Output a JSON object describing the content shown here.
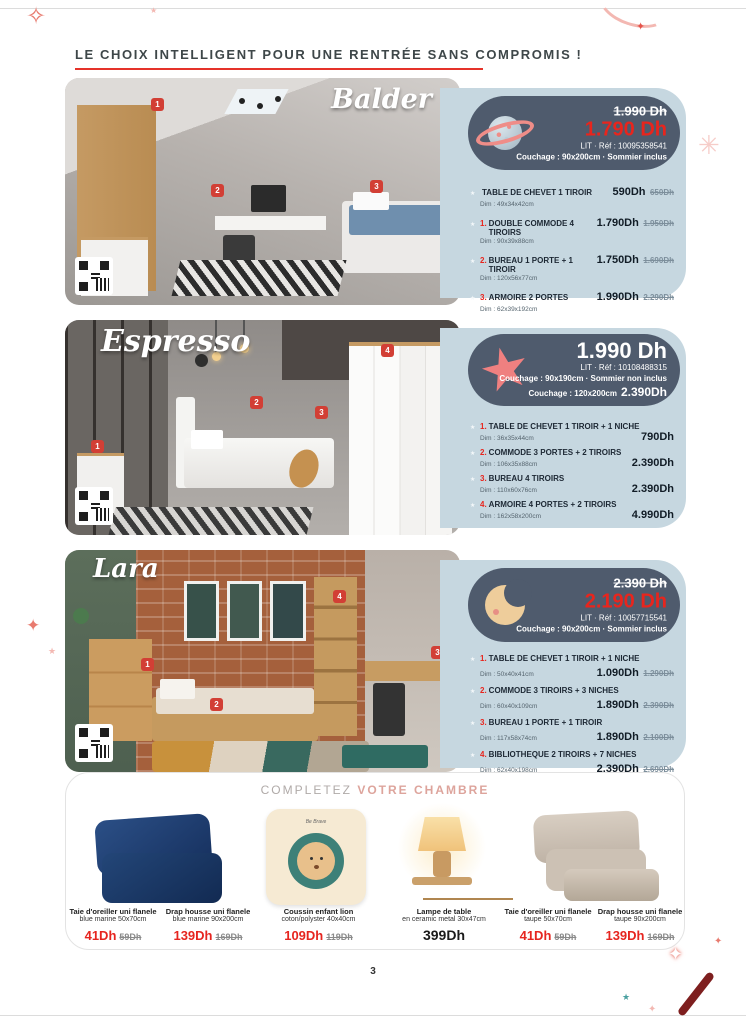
{
  "page": {
    "header": "LE CHOIX INTELLIGENT POUR UNE RENTRÉE SANS COMPROMIS !",
    "number": "3"
  },
  "colors": {
    "accent_red": "#E8251D",
    "panel_blue": "#C6D7E0",
    "pill_navy": "#4F5B6D",
    "badge_red": "#D23F35",
    "highlight_pink": "#DDA49C"
  },
  "sets": [
    {
      "title": "Balder",
      "icon": "planet-icon",
      "badges": [
        "1",
        "2",
        "3"
      ],
      "panel": {
        "old_price": "1.990 Dh",
        "price": "1.790 Dh",
        "ref": "LIT · Réf : 10095358541",
        "couchage": "Couchage : 90x200cm · Sommier inclus"
      },
      "items": [
        {
          "num": "",
          "name": "TABLE DE CHEVET 1 TIROIR",
          "dim": "Dim : 49x34x42cm",
          "price": "590Dh",
          "old_price": "650Dh"
        },
        {
          "num": "1.",
          "name": "DOUBLE COMMODE 4 TIROIRS",
          "dim": "Dim : 90x39x88cm",
          "price": "1.790Dh",
          "old_price": "1.950Dh"
        },
        {
          "num": "2.",
          "name": "BUREAU 1 PORTE + 1 TIROIR",
          "dim": "Dim : 120x56x77cm",
          "price": "1.750Dh",
          "old_price": "1.690Dh"
        },
        {
          "num": "3.",
          "name": "ARMOIRE 2 PORTES",
          "dim": "Dim : 62x39x192cm",
          "price": "1.990Dh",
          "old_price": "2.290Dh"
        }
      ]
    },
    {
      "title": "Espresso",
      "icon": "starfish-icon",
      "badges": [
        "1",
        "2",
        "3",
        "4"
      ],
      "panel": {
        "price": "1.990 Dh",
        "ref": "LIT · Réf : 10108488315",
        "couchage": "Couchage : 90x190cm · Sommier non inclus",
        "couchage2_label": "Couchage : 120x200cm",
        "couchage2_price": "2.390Dh"
      },
      "items": [
        {
          "num": "1.",
          "name": "TABLE DE CHEVET 1 TIROIR + 1 NICHE",
          "dim": "Dim : 36x35x44cm",
          "price": "790Dh"
        },
        {
          "num": "2.",
          "name": "COMMODE 3 PORTES + 2 TIROIRS",
          "dim": "Dim : 106x35x88cm",
          "price": "2.390Dh"
        },
        {
          "num": "3.",
          "name": "BUREAU 4 TIROIRS",
          "dim": "Dim : 110x60x76cm",
          "price": "2.390Dh"
        },
        {
          "num": "4.",
          "name": "ARMOIRE 4 PORTES + 2 TIROIRS",
          "dim": "Dim : 162x58x200cm",
          "price": "4.990Dh"
        }
      ]
    },
    {
      "title": "Lara",
      "icon": "moon-icon",
      "badges": [
        "1",
        "2",
        "3",
        "4"
      ],
      "panel": {
        "old_price": "2.390 Dh",
        "price": "2.190 Dh",
        "ref": "LIT · Réf : 10057715541",
        "couchage": "Couchage : 90x200cm · Sommier inclus"
      },
      "items": [
        {
          "num": "1.",
          "name": "TABLE DE CHEVET 1 TIROIR + 1 NICHE",
          "dim": "Dim : 50x40x41cm",
          "price": "1.090Dh",
          "old_price": "1.290Dh"
        },
        {
          "num": "2.",
          "name": "COMMODE 3 TIROIRS + 3 NICHES",
          "dim": "Dim : 60x40x109cm",
          "price": "1.890Dh",
          "old_price": "2.390Dh"
        },
        {
          "num": "3.",
          "name": "BUREAU 1 PORTE + 1 TIROIR",
          "dim": "Dim : 117x58x74cm",
          "price": "1.890Dh",
          "old_price": "2.100Dh"
        },
        {
          "num": "4.",
          "name": "BIBLIOTHEQUE 2 TIROIRS + 7 NICHES",
          "dim": "Dim : 62x40x198cm",
          "price": "2.390Dh",
          "old_price": "2.690Dh"
        }
      ]
    }
  ],
  "complete_section": {
    "prefix": "COMPLETEZ",
    "highlight": "VOTRE CHAMBRE",
    "cushion_text": "Be Brave",
    "products": [
      {
        "name": "Taie d'oreiller uni flanele",
        "desc": "blue marine 50x70cm",
        "price": "41Dh",
        "old_price": "59Dh"
      },
      {
        "name": "Drap housse uni flanele",
        "desc": "blue marine 90x200cm",
        "price": "139Dh",
        "old_price": "169Dh"
      },
      {
        "name": "Coussin enfant lion",
        "desc": "coton/polyster  40x40cm",
        "price": "109Dh",
        "old_price": "119Dh"
      },
      {
        "name": "Lampe de table",
        "desc": "en ceramic metal  30x47cm",
        "price": "399Dh",
        "old_price": ""
      },
      {
        "name": "Taie d'oreiller uni flanele",
        "desc": "taupe 50x70cm",
        "price": "41Dh",
        "old_price": "59Dh"
      },
      {
        "name": "Drap housse uni flanele",
        "desc": "taupe 90x200cm",
        "price": "139Dh",
        "old_price": "169Dh"
      }
    ]
  }
}
